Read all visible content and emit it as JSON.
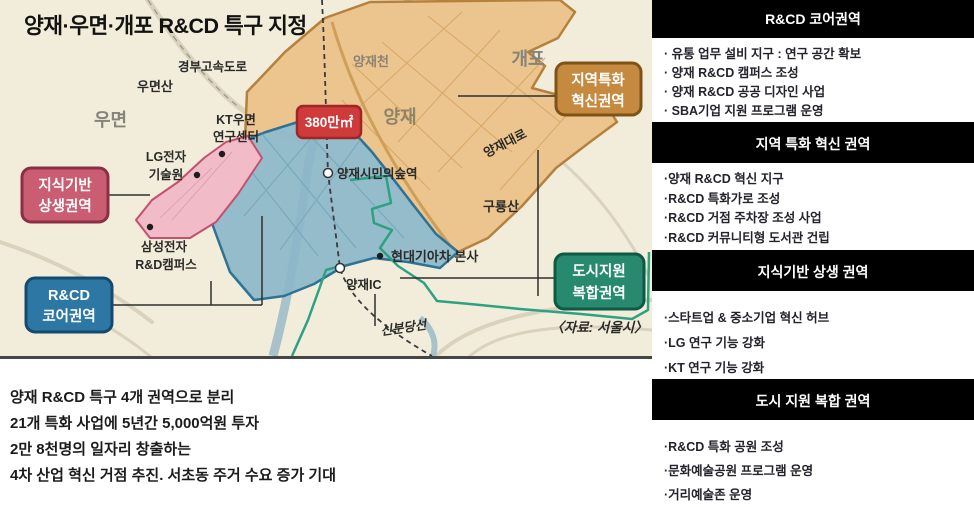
{
  "map": {
    "title": "양재·우면·개포 R&CD 특구 지정",
    "area_badge": "380만㎡",
    "badge_color": "#cf3a3a",
    "source": "〈자료: 서울시〉",
    "labels": {
      "expressway": "경부고속도로",
      "umyeonsan": "우면산",
      "umyeon": "우면",
      "kt1": "KT우면",
      "kt2": "연구센터",
      "lg1": "LG전자",
      "lg2": "기술원",
      "samsung1": "삼성전자",
      "samsung2": "R&D캠퍼스",
      "yangjaecheon": "양재천",
      "gaepo": "개포",
      "yangjae": "양재",
      "yangjae_daero": "양재대로",
      "forest_station": "양재시민의숲역",
      "guryongsan": "구룡산",
      "hyundai_kia": "현대기아차 본사",
      "yangjae_ic": "양재IC",
      "sinbundang": "신분당선"
    },
    "callouts": {
      "knowledge": {
        "line1": "지식기반",
        "line2": "상생권역",
        "color": "#ca5d72"
      },
      "core": {
        "line1": "R&CD",
        "line2": "코어권역",
        "color": "#2d77a4"
      },
      "regional": {
        "line1": "지역특화",
        "line2": "혁신권역",
        "color": "#c5893f"
      },
      "urban": {
        "line1": "도시지원",
        "line2": "복합권역",
        "color": "#278a6f"
      }
    }
  },
  "summary": {
    "lines": [
      "양재 R&CD 특구 4개 권역으로 분리",
      "21개 특화 사업에 5년간 5,000억원 투자",
      "2만 8천명의 일자리 창출하는",
      "4차 산업 혁신 거점 추진. 서초동 주거 수요 증가 기대"
    ]
  },
  "sidebar": {
    "sections": [
      {
        "title": "R&CD 코어권역",
        "items": [
          "· 유통 업무 설비 지구 : 연구 공간 확보",
          "· 양재 R&CD 캠퍼스 조성",
          "· 양재 R&CD 공공 디자인 사업",
          "· SBA기업 지원 프로그램 운영"
        ]
      },
      {
        "title": "지역 특화 혁신 권역",
        "items": [
          "·양재 R&CD 혁신 지구",
          "·R&CD 특화가로 조성",
          "·R&CD 거점 주차장 조성 사업",
          "·R&CD 커뮤니티형 도서관 건립"
        ]
      },
      {
        "title": "지식기반 상생 권역",
        "items": [
          "·스타트업 & 중소기업 혁신 허브",
          "·LG 연구 기능 강화",
          "·KT 연구 기능 강화"
        ]
      },
      {
        "title": "도시 지원 복합 권역",
        "items": [
          "·R&CD 특화 공원 조성",
          "·문화예술공원 프로그램 운영",
          "·거리예술존 운영"
        ]
      }
    ]
  }
}
